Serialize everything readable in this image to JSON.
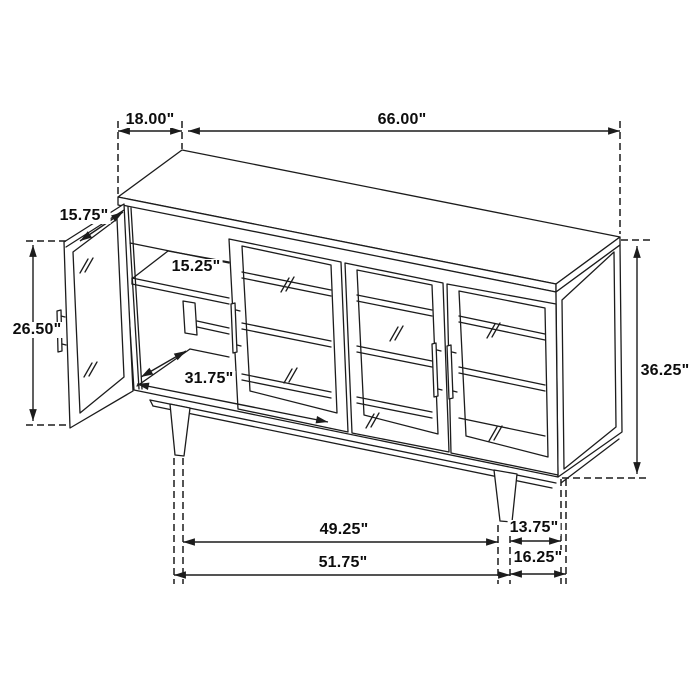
{
  "figure": {
    "type": "furniture-dimension-line-drawing",
    "colors": {
      "line": "#1c1c1c",
      "background": "#ffffff"
    }
  },
  "dimensions": {
    "depth": "18.00\"",
    "width": "66.00\"",
    "door_width": "15.75\"",
    "door_height": "26.50\"",
    "shelf_depth": "15.25\"",
    "interior_width": "31.75\"",
    "height": "36.25\"",
    "legs_inner_span": "49.25\"",
    "leg_inset_depth": "13.75\"",
    "legs_outer_span": "51.75\"",
    "base_overhang": "16.25\""
  }
}
